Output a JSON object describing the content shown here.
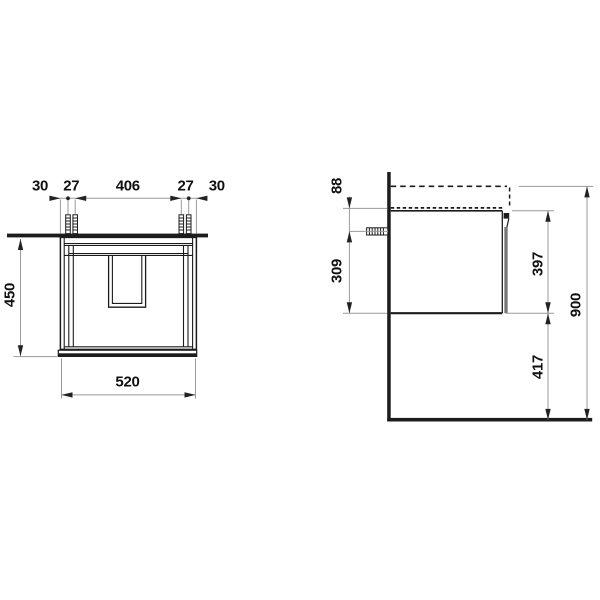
{
  "front_view": {
    "top_dims": [
      "30",
      "27",
      "406",
      "27",
      "30"
    ],
    "height": "450",
    "width": "520"
  },
  "side_view": {
    "top_to_screw": "88",
    "screw_to_bottom": "309",
    "cabinet_height": "397",
    "floor_clearance": "417",
    "total_height": "900"
  },
  "colors": {
    "line": "#1c1c1c",
    "dim": "#9a9a9a",
    "arrow": "#222222",
    "label": "#101010",
    "bg": "#ffffff"
  }
}
